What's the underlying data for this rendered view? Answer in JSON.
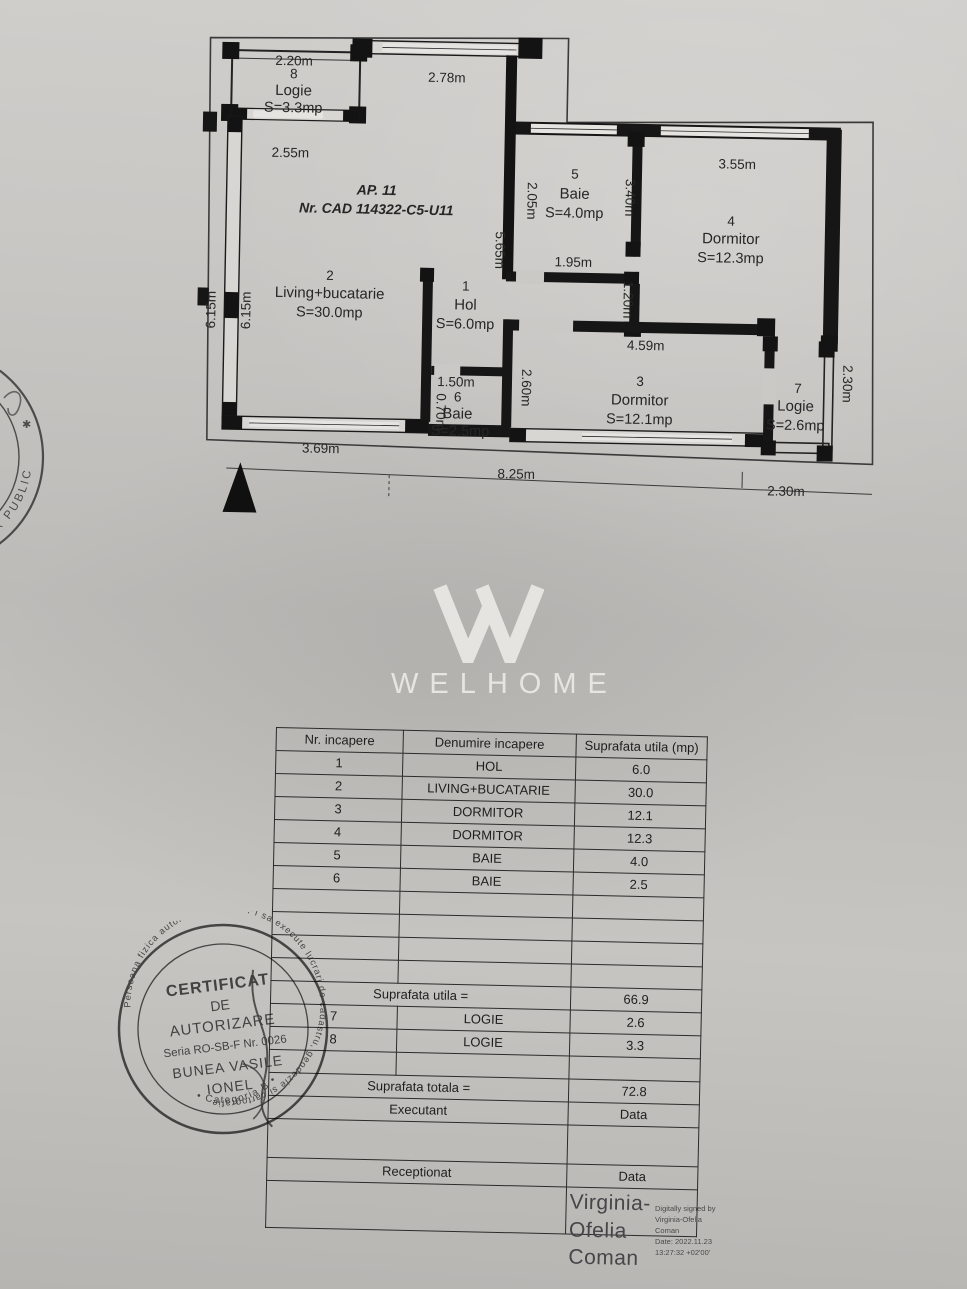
{
  "plan": {
    "apt_title": "AP. 11",
    "cad_ref": "Nr. CAD 114322-C5-U11",
    "rooms": {
      "logie8": {
        "num": "8",
        "name": "Logie",
        "area": "S=3.3mp"
      },
      "living": {
        "num": "2",
        "name": "Living+bucatarie",
        "area": "S=30.0mp"
      },
      "hol": {
        "num": "1",
        "name": "Hol",
        "area": "S=6.0mp"
      },
      "baie6": {
        "num": "6",
        "name": "Baie",
        "area": "S=2.5mp"
      },
      "baie5": {
        "num": "5",
        "name": "Baie",
        "area": "S=4.0mp"
      },
      "dorm4": {
        "num": "4",
        "name": "Dormitor",
        "area": "S=12.3mp"
      },
      "dorm3": {
        "num": "3",
        "name": "Dormitor",
        "area": "S=12.1mp"
      },
      "logie7": {
        "num": "7",
        "name": "Logie",
        "area": "S=2.6mp"
      }
    },
    "dims": {
      "logie8_top": "2.20m",
      "logie8_bottom": "2.55m",
      "top_mid": "2.78m",
      "left_outer": "6.15m",
      "left_inner": "6.15m",
      "hall_wall": "5.65m",
      "baie5_left": "2.05m",
      "baie5_bottom": "1.95m",
      "dorm4_top": "3.55m",
      "dorm4_left": "3.40m",
      "dorm4_left2": "1.20m",
      "dorm3_top": "4.59m",
      "dorm3_left": "2.60m",
      "baie6_top": "1.50m",
      "baie6_left": "0.70m",
      "logie7_right": "2.30m",
      "living_bottom": "3.69m",
      "bottom_left": "8.25m",
      "bottom_right": "2.30m"
    }
  },
  "watermark": {
    "brand": "WELHOME"
  },
  "table": {
    "headers": [
      "Nr. incapere",
      "Denumire incapere",
      "Suprafata utila (mp)"
    ],
    "rooms": [
      {
        "nr": "1",
        "name": "HOL",
        "area": "6.0"
      },
      {
        "nr": "2",
        "name": "LIVING+BUCATARIE",
        "area": "30.0"
      },
      {
        "nr": "3",
        "name": "DORMITOR",
        "area": "12.1"
      },
      {
        "nr": "4",
        "name": "DORMITOR",
        "area": "12.3"
      },
      {
        "nr": "5",
        "name": "BAIE",
        "area": "4.0"
      },
      {
        "nr": "6",
        "name": "BAIE",
        "area": "2.5"
      }
    ],
    "suprafata_utila": {
      "label": "Suprafata utila =",
      "value": "66.9"
    },
    "logii": [
      {
        "nr": "7",
        "name": "LOGIE",
        "area": "2.6"
      },
      {
        "nr": "8",
        "name": "LOGIE",
        "area": "3.3"
      }
    ],
    "suprafata_totala": {
      "label": "Suprafata totala =",
      "value": "72.8"
    },
    "executant": {
      "label": "Executant",
      "data_label": "Data"
    },
    "receptionat": {
      "label": "Receptionat",
      "data_label": "Data"
    }
  },
  "stamps": {
    "authorization": {
      "ring_text": "Persoana fizica autorizata de ANCPI sa execute lucrari de cadastru, geodezie si cartografie",
      "category": "• Categoria B •",
      "title_line1": "CERTIFICAT",
      "title_line2": "DE",
      "title_line3": "AUTORIZARE",
      "series": "Seria RO-SB-F Nr. 0026",
      "holder_line1": "BUNEA VASILE",
      "holder_line2": "IONEL"
    },
    "notary": {
      "arc_text": "NOTAR PUBLIC"
    }
  },
  "signature": {
    "name_line1": "Virginia-",
    "name_line2": "Ofelia",
    "name_line3": "Coman",
    "digital_lines": [
      "Digitally signed by",
      "Virginia-Ofelia",
      "Coman",
      "Date: 2022.11.23",
      "13:27:32 +02'00'"
    ]
  }
}
